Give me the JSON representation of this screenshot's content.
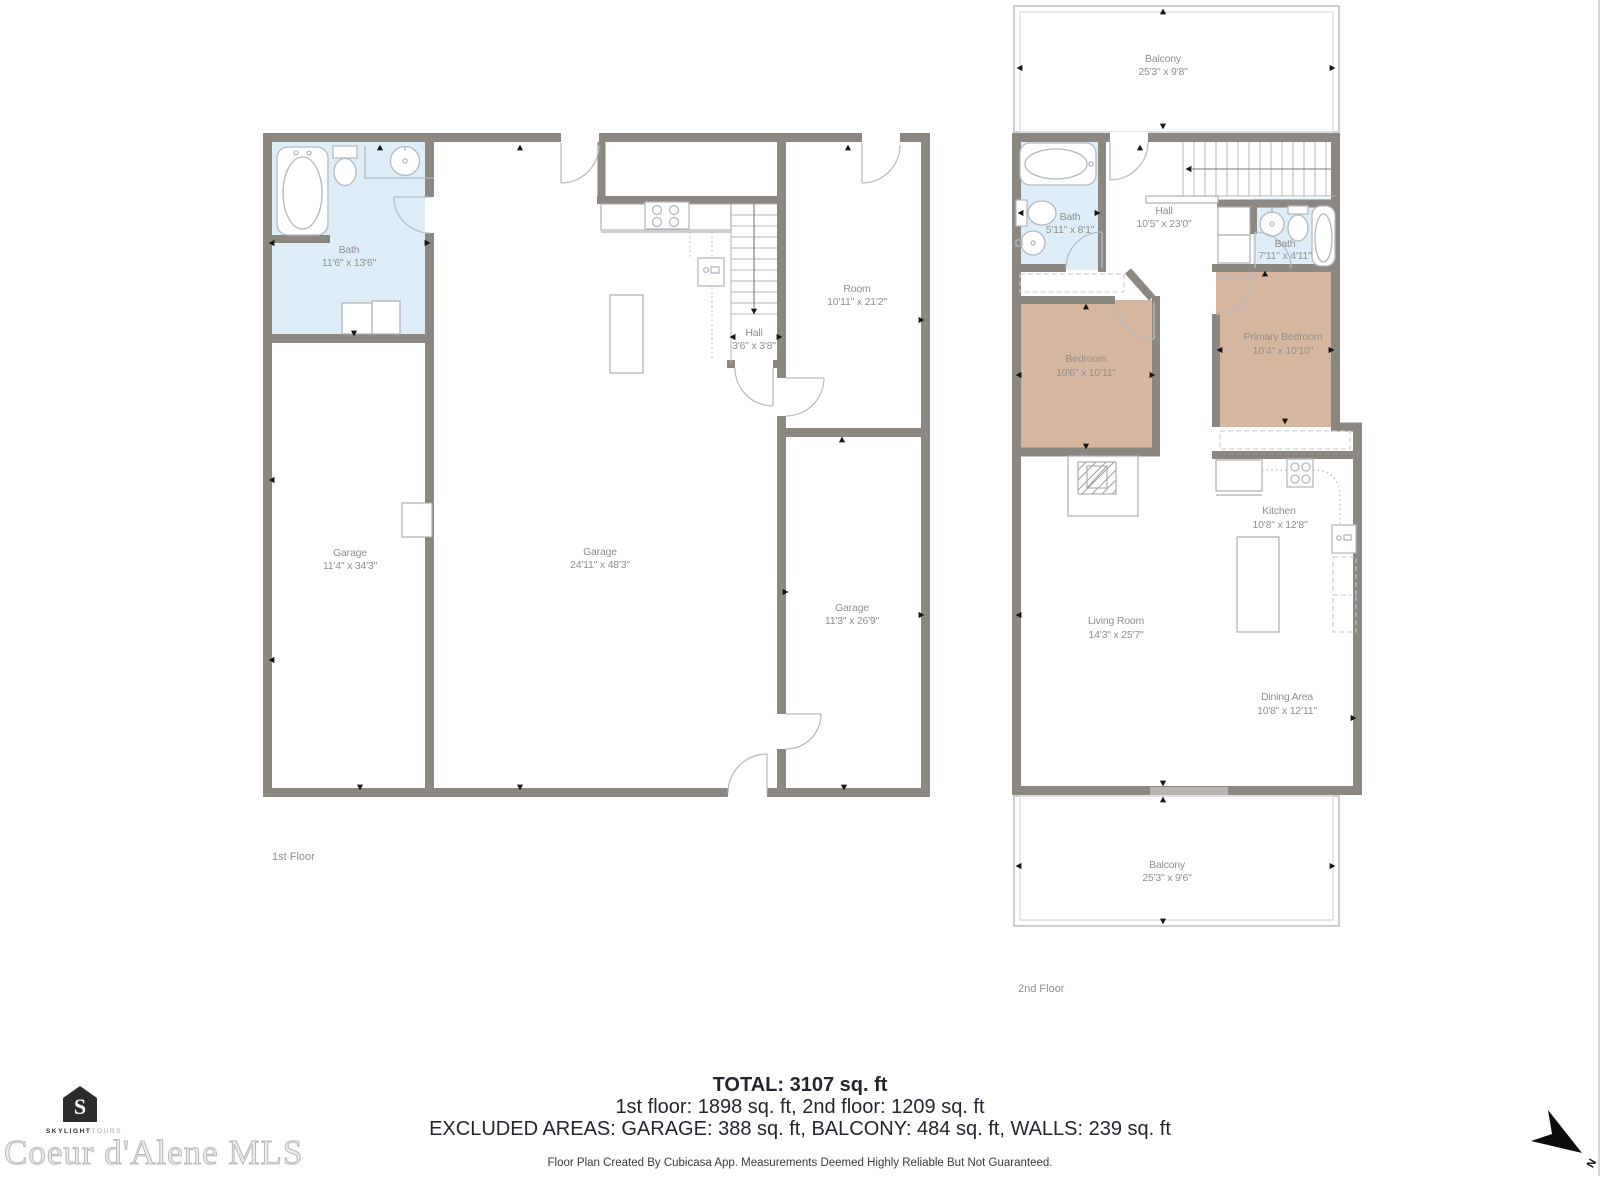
{
  "floor1": {
    "label": "1st Floor",
    "rooms": {
      "bath": {
        "name": "Bath",
        "dims": "11'6\" x 13'6\""
      },
      "garage_left": {
        "name": "Garage",
        "dims": "11'4\" x 34'3\""
      },
      "garage_main": {
        "name": "Garage",
        "dims": "24'11\" x 48'3\""
      },
      "hall": {
        "name": "Hall",
        "dims": "3'6\" x 3'8\""
      },
      "room": {
        "name": "Room",
        "dims": "10'11\" x 21'2\""
      },
      "garage_right": {
        "name": "Garage",
        "dims": "11'3\" x 26'9\""
      }
    }
  },
  "floor2": {
    "label": "2nd Floor",
    "rooms": {
      "balcony_top": {
        "name": "Balcony",
        "dims": "25'3\" x 9'8\""
      },
      "bath_left": {
        "name": "Bath",
        "dims": "5'11\" x 8'1\""
      },
      "hall": {
        "name": "Hall",
        "dims": "10'5\" x 23'0\""
      },
      "bath_right": {
        "name": "Bath",
        "dims": "7'11\" x 4'11\""
      },
      "bedroom": {
        "name": "Bedroom",
        "dims": "10'6\" x 10'11\""
      },
      "primary_bedroom": {
        "name": "Primary Bedroom",
        "dims": "10'4\" x 10'10\""
      },
      "kitchen": {
        "name": "Kitchen",
        "dims": "10'8\" x 12'8\""
      },
      "living_room": {
        "name": "Living Room",
        "dims": "14'3\" x 25'7\""
      },
      "dining_area": {
        "name": "Dining Area",
        "dims": "10'8\" x 12'11\""
      },
      "balcony_bottom": {
        "name": "Balcony",
        "dims": "25'3\" x 9'6\""
      }
    }
  },
  "summary": {
    "total": "TOTAL: 3107 sq. ft",
    "floors": "1st floor: 1898 sq. ft, 2nd floor: 1209 sq. ft",
    "excluded": "EXCLUDED AREAS: GARAGE: 388 sq. ft, BALCONY: 484 sq. ft, WALLS: 239 sq. ft",
    "disclaimer": "Floor Plan Created By Cubicasa App. Measurements Deemed Highly Reliable But Not Guaranteed."
  },
  "branding": {
    "logo_letter": "S",
    "logo_line_bold": "SKYLIGHT",
    "logo_line_light": "TOURS",
    "watermark": "Coeur d'Alene MLS"
  },
  "compass": {
    "north": "N"
  },
  "colors": {
    "wall": "#8c8781",
    "bath_fill": "#ddeef8",
    "bedroom_fill": "#d5b7a1",
    "label_text": "#8f8f8f",
    "summary_text": "#23262e"
  }
}
